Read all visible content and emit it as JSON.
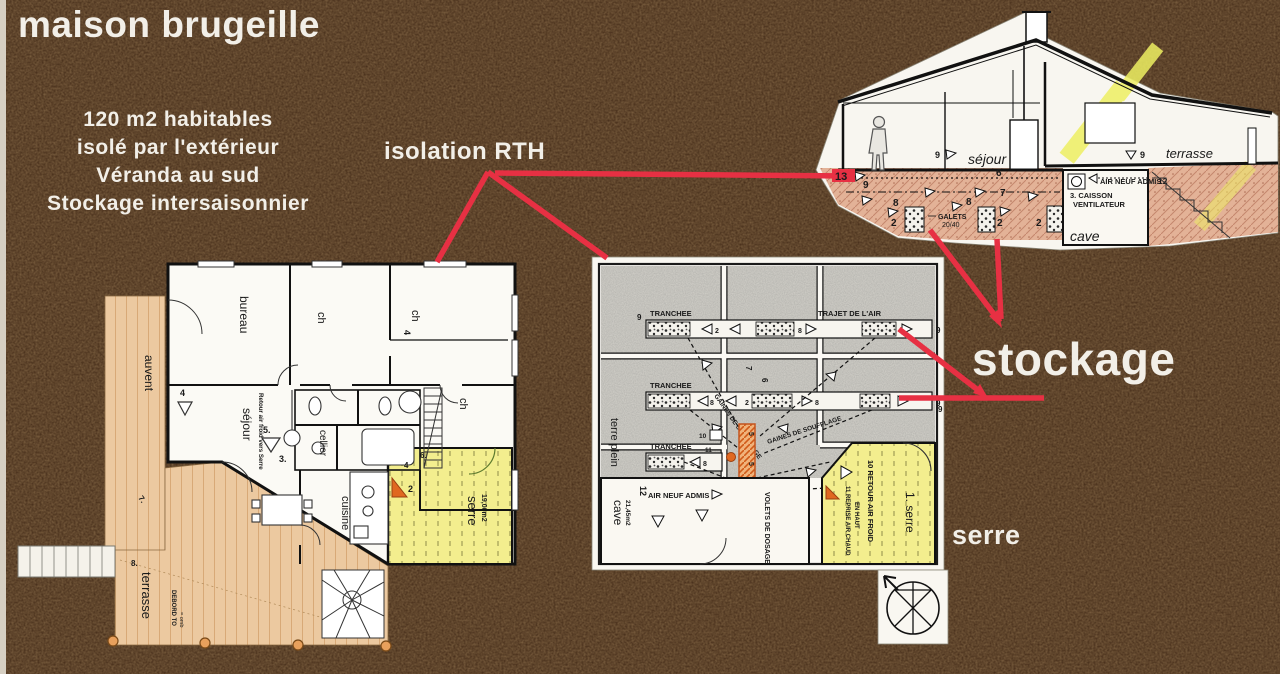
{
  "colors": {
    "background": "#3b2312",
    "red": "#e73043",
    "paper": "#f8f6f0",
    "tan": "#ecc9a0",
    "yellow": "#f3ee8e",
    "orange": "#e06820",
    "concrete": "#d5d3cc",
    "ground_pink": "#e2ad93"
  },
  "title": "maison brugeille",
  "subtitle_lines": [
    "120 m2 habitables",
    "isolé par l'extérieur",
    "Véranda au sud",
    "Stockage intersaisonnier"
  ],
  "annotations": {
    "isolation_rth": "isolation RTH",
    "stockage": "stockage",
    "serre": "serre"
  },
  "section": {
    "sejour": "séjour",
    "terrasse": "terrasse",
    "cave": "cave",
    "air_neuf_admis": "AIR NEUF ADMIS",
    "n12": "12",
    "caisson_line1": "3. CAISSON",
    "caisson_line2": "VENTILATEUR",
    "galets_line1": "GALETS",
    "galets_line2": "20/40",
    "n13": "13",
    "n9_wall": "9",
    "n9_terrasse": "9",
    "n9_ground": "9",
    "n6": "6",
    "n7": "7",
    "n8a": "8",
    "n8b": "8",
    "n2a": "2",
    "n2b": "2",
    "n2c": "2"
  },
  "storage": {
    "tranchee1": "TRANCHEE",
    "tranchee2": "TRANCHEE",
    "tranchee3": "TRANCHEE",
    "trajet": "TRAJET DE L'AIR",
    "gaines1": "GAINES DE SOUFFLAGE",
    "gaines2": "GAINES DE SOUFFLAGE",
    "terre_plein": "terre plein",
    "cave": "cave",
    "cave_area": "21,45m2",
    "n12": "12",
    "air_neuf": "AIR NEUF ADMIS",
    "volets": "VOLETS DE DOSAGE",
    "retour": "10 RETOUR AIR FROID",
    "reprise1": "11 REPRISE AIR CHAUD",
    "reprise2": "EN HAUT",
    "serre": "1. serre",
    "n2": "2",
    "n8a": "8",
    "n8b": "8",
    "n8c": "8",
    "n9a": "9",
    "n9b": "9",
    "n9c": "9",
    "n9d": "9",
    "n6": "6",
    "n7": "7",
    "n10": "10",
    "n11": "11",
    "n3": "3",
    "n4": "4",
    "n5a": "5",
    "n5b": "5"
  },
  "floor": {
    "auvent": "auvent",
    "bureau": "bureau",
    "ch1": "ch",
    "ch2": "ch",
    "ch3": "ch",
    "n4_ch": "4",
    "sejour": "séjour",
    "cellier": "cellier",
    "cuisine": "cuisine",
    "serre": "serre",
    "serre_area": "19,00m2",
    "terrasse": "terrasse",
    "retour_note": "Retour air froid vers Serre",
    "debord1": "DEBORD TO",
    "debord2": "= omb",
    "n4a": "4",
    "n5": "5.",
    "n3": "3.",
    "n2": "2",
    "n4b": "4",
    "n7": "7.",
    "n8": "8.",
    "n6": "6."
  }
}
